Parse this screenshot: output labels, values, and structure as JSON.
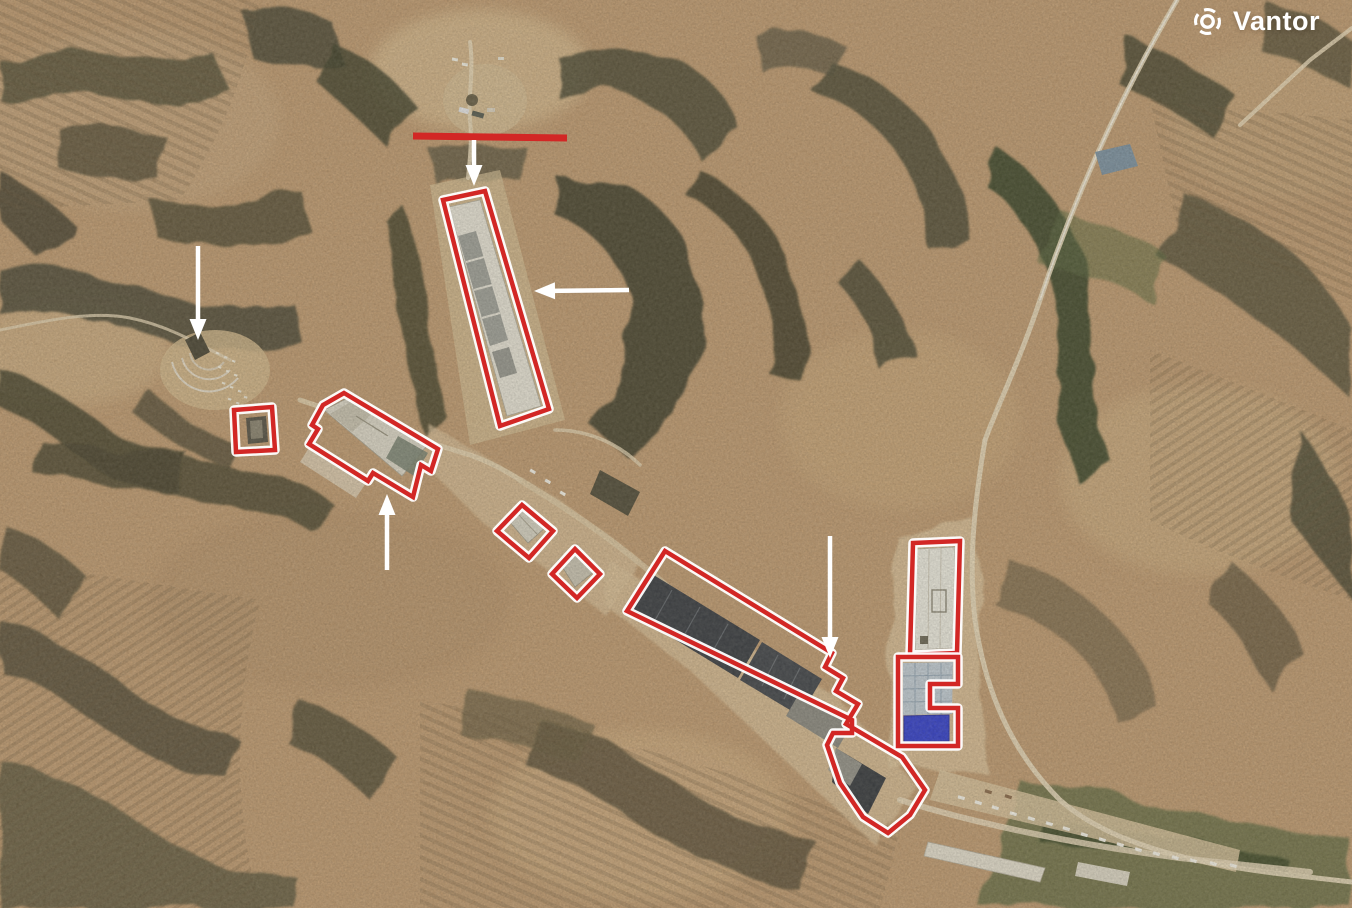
{
  "meta": {
    "width": 1352,
    "height": 908,
    "scene": "annotated satellite image of construction site in terraced loess terrain"
  },
  "branding": {
    "logo_text": "Vantor",
    "logo_icon": "vantor-aperture-icon",
    "logo_color": "#ffffff"
  },
  "palette": {
    "annotation_red": "#d22725",
    "annotation_casing": "#ffffff",
    "arrow_white": "#ffffff",
    "terrain_tan": "#c09c72",
    "vegetation_dark": "#4b4832",
    "blue_roof": "#3844cb"
  },
  "annotations": {
    "red_line": {
      "x1": 413,
      "y1": 136,
      "x2": 567,
      "y2": 138,
      "width": 7
    },
    "outline_style": {
      "stroke": "#d22725",
      "stroke_width": 4.5,
      "casing": "#ffffff",
      "casing_width": 9.5
    },
    "arrow_style": {
      "color": "#ffffff",
      "shaft_width": 4.5,
      "head_length": 21,
      "head_width": 17
    },
    "outlines": [
      {
        "name": "outline-north-long-building",
        "path": "M443,200 L485,191 L549,409 L500,426 Z"
      },
      {
        "name": "outline-west-small-square",
        "path": "M234,410 L272,407 L275,450 L236,452 Z"
      },
      {
        "name": "outline-west-complex",
        "path": "M344,393 L438,449 L431,471 L421,465 L413,497 L373,473 L368,481 L309,444 L318,429 L312,425 L323,405 Z"
      },
      {
        "name": "outline-center-small-a",
        "path": "M522,505 L553,531 L529,558 L497,531 Z"
      },
      {
        "name": "outline-center-small-b",
        "path": "M575,549 L600,574 L577,598 L552,574 Z"
      },
      {
        "name": "outline-central-complex",
        "path": "M665,551 L832,653 L825,667 L843,678 L836,691 L858,704 L846,724 L902,757 L925,790 L910,815 L888,833 L863,817 L840,783 L827,745 L833,733 L852,733 L852,720 L627,611 Z"
      },
      {
        "name": "outline-east-building",
        "path": "M913,543 L960,541 L957,653 L910,655 Z"
      },
      {
        "name": "outline-east-blue-roof-building",
        "path": "M898,657 L958,657 L958,684 L930,684 L930,708 L958,708 L958,746 L898,746 Z"
      }
    ],
    "arrows": [
      {
        "name": "arrow-north-site",
        "tail": [
          474,
          140
        ],
        "tip": [
          474,
          186
        ]
      },
      {
        "name": "arrow-west-site",
        "tail": [
          198,
          246
        ],
        "tip": [
          198,
          340
        ]
      },
      {
        "name": "arrow-north-building",
        "tail": [
          629,
          290
        ],
        "tip": [
          534,
          291
        ]
      },
      {
        "name": "arrow-west-complex",
        "tail": [
          387,
          570
        ],
        "tip": [
          387,
          494
        ]
      },
      {
        "name": "arrow-central-complex",
        "tail": [
          830,
          536
        ],
        "tip": [
          830,
          658
        ]
      }
    ]
  }
}
